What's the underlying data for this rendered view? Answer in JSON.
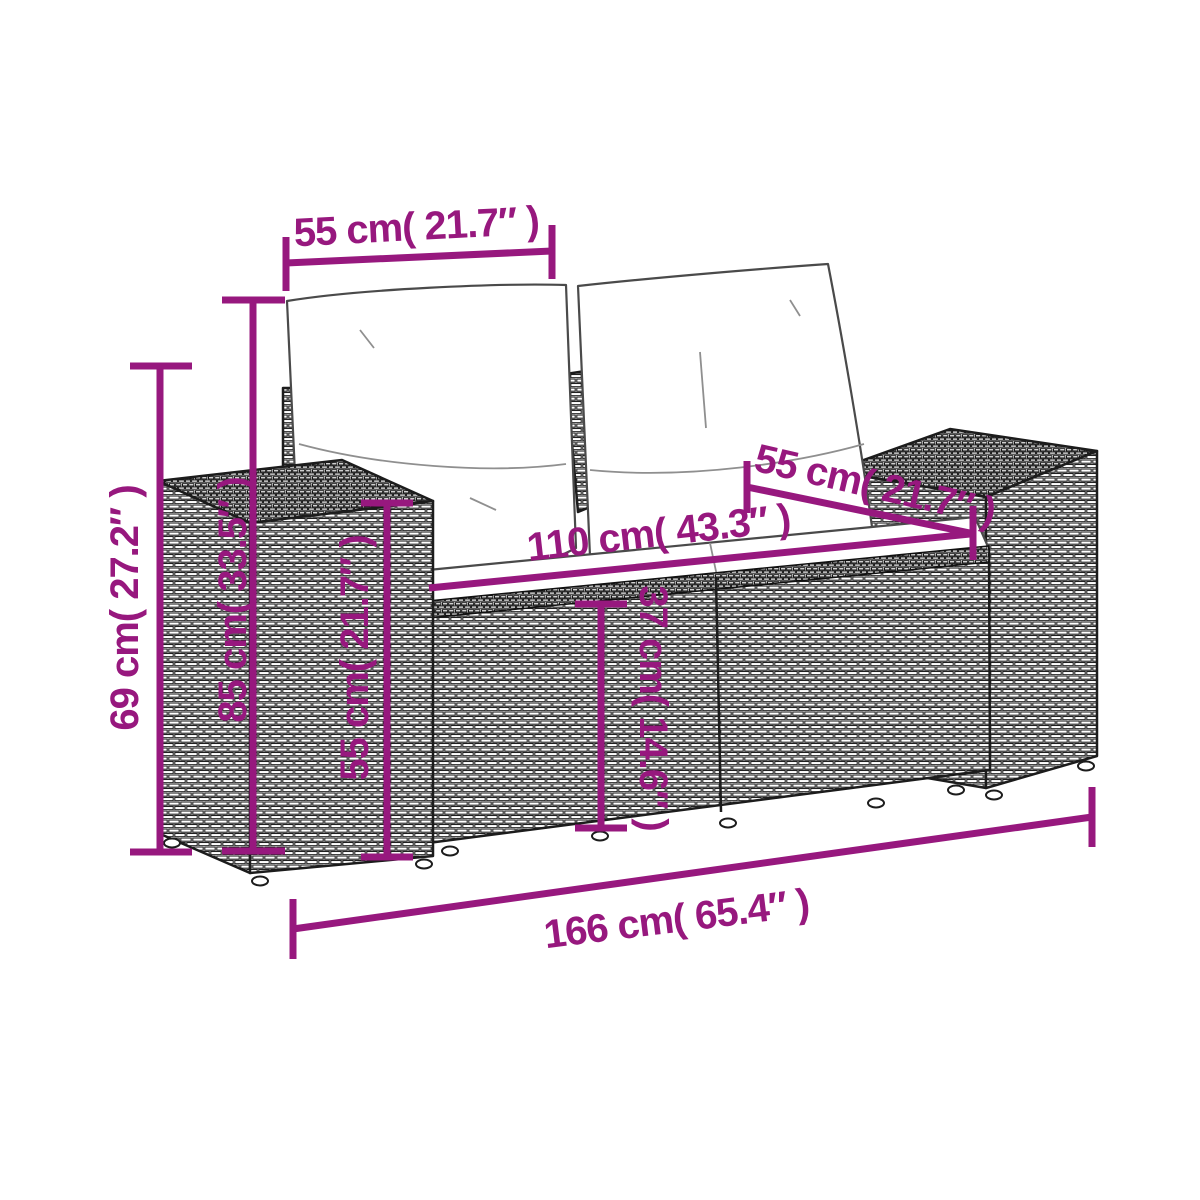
{
  "diagram": {
    "kind": "furniture-dimension-diagram",
    "annotation_color": "#97187E",
    "outline_color": "#1c1c1c",
    "background_color": "#ffffff",
    "dimensions": {
      "back_cushion_width": {
        "label": "55 cm( 21.7″ )",
        "cm": "55",
        "inches": "21.7"
      },
      "seat_depth": {
        "label": "55 cm( 21.7″ )",
        "cm": "55",
        "inches": "21.7"
      },
      "seat_width": {
        "label": "110 cm( 43.3″ )",
        "cm": "110",
        "inches": "43.3"
      },
      "overall_width": {
        "label": "166 cm( 65.4″ )",
        "cm": "166",
        "inches": "65.4"
      },
      "side_height": {
        "label": "69 cm( 27.2″ )",
        "cm": "69",
        "inches": "27.2"
      },
      "overall_height": {
        "label": "85 cm( 33.5″ )",
        "cm": "85",
        "inches": "33.5"
      },
      "armrest_height": {
        "label": "55 cm( 21.7″ )",
        "cm": "55",
        "inches": "21.7"
      },
      "seat_height": {
        "label": "37 cm( 14.6″ )",
        "cm": "37",
        "inches": "14.6"
      }
    }
  }
}
